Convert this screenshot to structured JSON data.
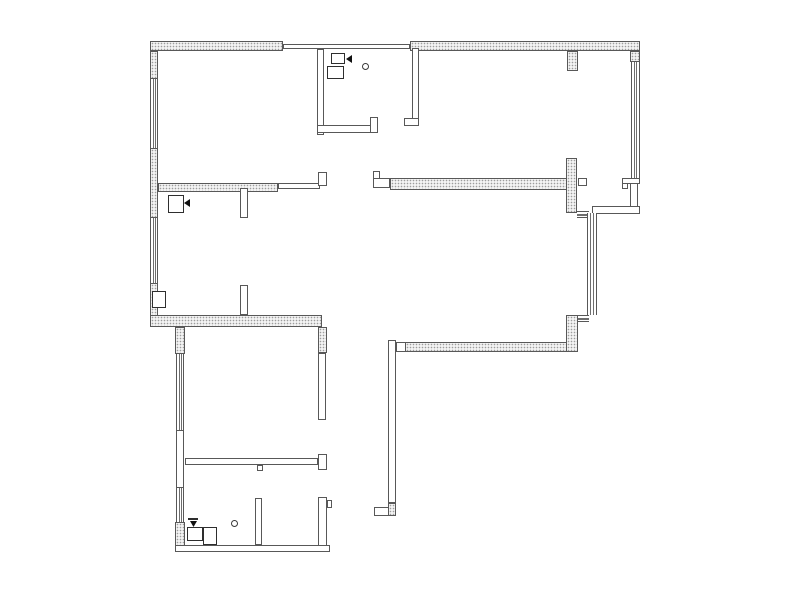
{
  "meta": {
    "canvas": {
      "width": 800,
      "height": 594
    },
    "colors": {
      "background": "#ffffff",
      "wall_line": "#585858",
      "hatch_dot": "#9d9d9d",
      "hatch_fill": "#f3f3f3",
      "symbol_line": "#2e2e2e",
      "symbol_solid": "#111111"
    }
  },
  "plan": {
    "elements": [
      {
        "name": "top-wall-west",
        "type": "hatch",
        "x": 150,
        "y": 41,
        "w": 133,
        "h": 10
      },
      {
        "name": "top-wall-center-thin",
        "type": "wall",
        "x": 283,
        "y": 44,
        "w": 127,
        "h": 5
      },
      {
        "name": "top-wall-east",
        "type": "hatch",
        "x": 410,
        "y": 41,
        "w": 230,
        "h": 10
      },
      {
        "name": "top-wall-stub",
        "type": "hatch",
        "x": 567,
        "y": 51,
        "w": 11,
        "h": 20
      },
      {
        "name": "west-wall-upper",
        "type": "hatch",
        "x": 150,
        "y": 51,
        "w": 8,
        "h": 28
      },
      {
        "name": "west-wall-window-1",
        "type": "win-v",
        "x": 150,
        "y": 79,
        "w": 8,
        "h": 69
      },
      {
        "name": "west-wall-mid",
        "type": "hatch",
        "x": 150,
        "y": 148,
        "w": 8,
        "h": 70
      },
      {
        "name": "west-wall-window-2",
        "type": "win-v",
        "x": 150,
        "y": 218,
        "w": 8,
        "h": 65
      },
      {
        "name": "west-wall-lower",
        "type": "hatch",
        "x": 150,
        "y": 283,
        "w": 8,
        "h": 44
      },
      {
        "name": "bedroom1-south-wall",
        "type": "hatch",
        "x": 158,
        "y": 183,
        "w": 120,
        "h": 9
      },
      {
        "name": "bedroom1-south-wall-thin",
        "type": "wall",
        "x": 278,
        "y": 183,
        "w": 42,
        "h": 6
      },
      {
        "name": "bedroom1-door-jamb",
        "type": "wall",
        "x": 318,
        "y": 172,
        "w": 9,
        "h": 14
      },
      {
        "name": "hall-door-jamb",
        "type": "wall",
        "x": 373,
        "y": 171,
        "w": 7,
        "h": 9
      },
      {
        "name": "hall-wall-thin",
        "type": "wall",
        "x": 373,
        "y": 178,
        "w": 17,
        "h": 10
      },
      {
        "name": "living-north-wall",
        "type": "hatch",
        "x": 390,
        "y": 178,
        "w": 177,
        "h": 12
      },
      {
        "name": "cross-wall-vertical",
        "type": "hatch",
        "x": 566,
        "y": 158,
        "w": 11,
        "h": 55
      },
      {
        "name": "cross-wall-stub-east",
        "type": "wall",
        "x": 578,
        "y": 178,
        "w": 9,
        "h": 8
      },
      {
        "name": "bedroom3-door-jamb",
        "type": "wall",
        "x": 622,
        "y": 178,
        "w": 18,
        "h": 6
      },
      {
        "name": "bedroom3-door-jamb-tooth",
        "type": "wall",
        "x": 622,
        "y": 183,
        "w": 6,
        "h": 6
      },
      {
        "name": "east-wall-corner",
        "type": "hatch",
        "x": 630,
        "y": 51,
        "w": 10,
        "h": 11
      },
      {
        "name": "east-wall-window",
        "type": "win-v",
        "x": 631,
        "y": 62,
        "w": 9,
        "h": 116
      },
      {
        "name": "east-wall-lower",
        "type": "wall",
        "x": 630,
        "y": 183,
        "w": 8,
        "h": 31
      },
      {
        "name": "east-step-wall",
        "type": "wall",
        "x": 592,
        "y": 206,
        "w": 48,
        "h": 8
      },
      {
        "name": "balcony-window-top-link",
        "type": "win-h",
        "x": 577,
        "y": 211,
        "w": 12,
        "h": 7
      },
      {
        "name": "balcony-window",
        "type": "win-v",
        "x": 587,
        "y": 213,
        "w": 10,
        "h": 102
      },
      {
        "name": "balcony-window-bottom-link",
        "type": "win-h",
        "x": 577,
        "y": 315,
        "w": 12,
        "h": 7
      },
      {
        "name": "east-wall-mid-hatch",
        "type": "hatch",
        "x": 566,
        "y": 315,
        "w": 12,
        "h": 37
      },
      {
        "name": "living-south-wall",
        "type": "hatch",
        "x": 405,
        "y": 342,
        "w": 162,
        "h": 10
      },
      {
        "name": "living-south-wall-thin",
        "type": "wall",
        "x": 396,
        "y": 342,
        "w": 10,
        "h": 10
      },
      {
        "name": "entry-wall-vertical",
        "type": "wall",
        "x": 388,
        "y": 340,
        "w": 8,
        "h": 163
      },
      {
        "name": "entry-wall-cap",
        "type": "hatch",
        "x": 388,
        "y": 503,
        "w": 8,
        "h": 13
      },
      {
        "name": "entry-wall-box",
        "type": "wall",
        "x": 374,
        "y": 507,
        "w": 15,
        "h": 9
      },
      {
        "name": "living-southwest-wall",
        "type": "hatch",
        "x": 150,
        "y": 315,
        "w": 172,
        "h": 12
      },
      {
        "name": "junction-wall",
        "type": "hatch",
        "x": 318,
        "y": 327,
        "w": 9,
        "h": 26
      },
      {
        "name": "bedroom2-west-upper",
        "type": "hatch",
        "x": 175,
        "y": 327,
        "w": 10,
        "h": 27
      },
      {
        "name": "bedroom2-west-window-1",
        "type": "win-v",
        "x": 176,
        "y": 354,
        "w": 8,
        "h": 76
      },
      {
        "name": "bedroom2-west-plain",
        "type": "wall",
        "x": 176,
        "y": 430,
        "w": 8,
        "h": 58
      },
      {
        "name": "bedroom2-west-window-2",
        "type": "win-v",
        "x": 176,
        "y": 488,
        "w": 8,
        "h": 34
      },
      {
        "name": "bathroom2-west-hatch",
        "type": "hatch",
        "x": 175,
        "y": 522,
        "w": 10,
        "h": 30
      },
      {
        "name": "bedroom2-east-wall",
        "type": "wall",
        "x": 318,
        "y": 353,
        "w": 8,
        "h": 67
      },
      {
        "name": "bedroom2-south-wall",
        "type": "wall",
        "x": 185,
        "y": 458,
        "w": 133,
        "h": 7
      },
      {
        "name": "bedroom2-south-cap",
        "type": "wall",
        "x": 318,
        "y": 454,
        "w": 9,
        "h": 16
      },
      {
        "name": "bedroom2-south-stub",
        "type": "wall",
        "x": 257,
        "y": 465,
        "w": 6,
        "h": 6
      },
      {
        "name": "bathroom2-east-wall",
        "type": "wall",
        "x": 318,
        "y": 497,
        "w": 9,
        "h": 55
      },
      {
        "name": "bathroom2-east-tooth",
        "type": "wall",
        "x": 327,
        "y": 500,
        "w": 5,
        "h": 8
      },
      {
        "name": "bathroom2-partition",
        "type": "wall",
        "x": 255,
        "y": 498,
        "w": 7,
        "h": 47
      },
      {
        "name": "south-wall",
        "type": "wall",
        "x": 175,
        "y": 545,
        "w": 155,
        "h": 7
      },
      {
        "name": "bathroom1-west-wall",
        "type": "wall",
        "x": 317,
        "y": 49,
        "w": 7,
        "h": 86
      },
      {
        "name": "bathroom1-south-wall",
        "type": "wall",
        "x": 317,
        "y": 125,
        "w": 56,
        "h": 8
      },
      {
        "name": "bathroom1-south-jamb",
        "type": "wall",
        "x": 370,
        "y": 117,
        "w": 8,
        "h": 16
      },
      {
        "name": "bathroom1-east-wall",
        "type": "wall",
        "x": 412,
        "y": 48,
        "w": 7,
        "h": 78
      },
      {
        "name": "bathroom1-east-foot",
        "type": "wall",
        "x": 404,
        "y": 118,
        "w": 15,
        "h": 8
      },
      {
        "name": "dining-stub-north",
        "type": "wall",
        "x": 240,
        "y": 188,
        "w": 8,
        "h": 30
      },
      {
        "name": "dining-stub-south",
        "type": "wall",
        "x": 240,
        "y": 285,
        "w": 8,
        "h": 30
      },
      {
        "name": "bathroom1-fixture-box-1",
        "type": "box",
        "x": 331,
        "y": 53,
        "w": 14,
        "h": 11
      },
      {
        "name": "bathroom1-fixture-box-2",
        "type": "box",
        "x": 327,
        "y": 66,
        "w": 17,
        "h": 13
      },
      {
        "name": "bathroom1-door-arrow",
        "type": "tri-left",
        "x": 346,
        "y": 55,
        "w": 6,
        "h": 8
      },
      {
        "name": "bathroom1-fixture-circle",
        "type": "circle",
        "x": 362,
        "y": 63,
        "w": 7,
        "h": 7
      },
      {
        "name": "dining-fixture-box",
        "type": "box",
        "x": 168,
        "y": 195,
        "w": 16,
        "h": 18
      },
      {
        "name": "dining-door-arrow",
        "type": "tri-left",
        "x": 184,
        "y": 199,
        "w": 6,
        "h": 8
      },
      {
        "name": "living-wall-fixture-box",
        "type": "box",
        "x": 152,
        "y": 291,
        "w": 14,
        "h": 17
      },
      {
        "name": "bathroom2-valve-bar",
        "type": "bar",
        "x": 188,
        "y": 518,
        "w": 10,
        "h": 2
      },
      {
        "name": "bathroom2-valve-arrow",
        "type": "tri-down",
        "x": 190,
        "y": 521,
        "w": 7,
        "h": 6
      },
      {
        "name": "bathroom2-fixture-box-1",
        "type": "box",
        "x": 187,
        "y": 527,
        "w": 16,
        "h": 14
      },
      {
        "name": "bathroom2-fixture-box-2",
        "type": "box",
        "x": 203,
        "y": 527,
        "w": 14,
        "h": 18
      },
      {
        "name": "bathroom2-fixture-circle",
        "type": "circle",
        "x": 231,
        "y": 520,
        "w": 7,
        "h": 7
      }
    ]
  }
}
